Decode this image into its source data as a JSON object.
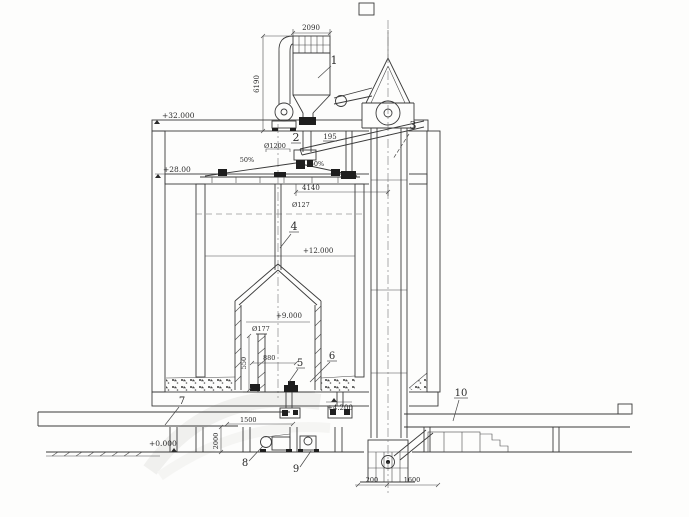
{
  "drawing": {
    "title": "silo-bucket-elevator-section",
    "part_labels": [
      "1",
      "2",
      "3",
      "4",
      "5",
      "6",
      "7",
      "8",
      "9",
      "10"
    ],
    "elevations": {
      "roof": "+32.000",
      "gallery_floor": "+28.00",
      "bin_level": "+12.000",
      "inner_top": "+9.000",
      "bin_bottom": "+4.200",
      "ground": "+0.000"
    },
    "dims": {
      "top_width": "2090",
      "collector_height": "6190",
      "spreader_dia": "Ø1200",
      "chute_mark": "195",
      "slope_left": "50%",
      "slope_right": "50%",
      "gallery_span": "4140",
      "pipe_dia": "Ø127",
      "inner_pipe_dia": "Ø177",
      "inner_height": "550",
      "inner_span": "880",
      "basement_height": "2000",
      "basement_span": "1500",
      "boot_a": "200",
      "boot_b": "1600"
    },
    "line_color": "#3a3a3a",
    "paper_color": "#fdfdfc"
  }
}
